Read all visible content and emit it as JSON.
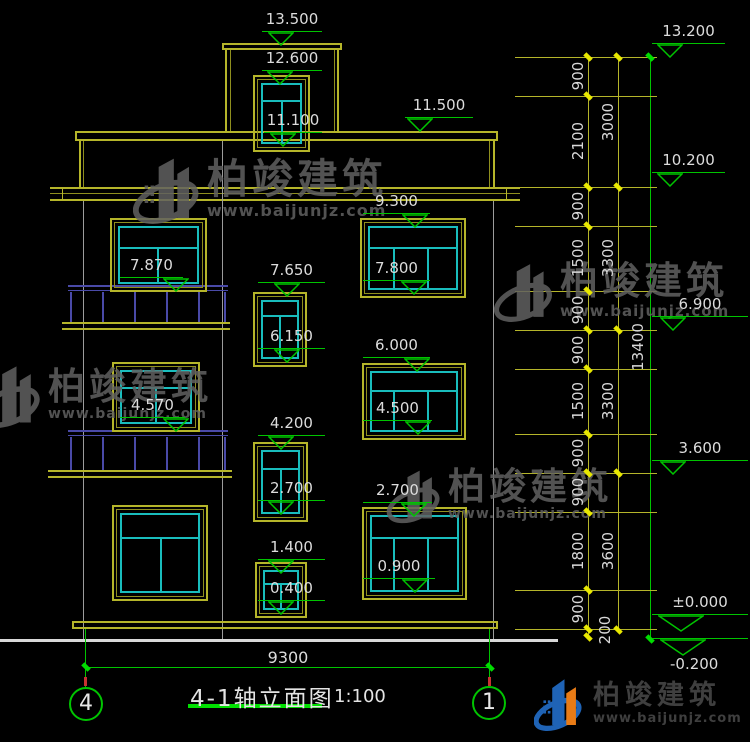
{
  "drawing": {
    "title": "4-1轴立面图",
    "scale": "1:100",
    "bottom_dim": "9300",
    "axis_left": "4",
    "axis_right": "1"
  },
  "elevations": [
    "13.500",
    "12.600",
    "11.100",
    "11.500",
    "9.300",
    "7.870",
    "7.650",
    "7.800",
    "6.150",
    "6.000",
    "4.570",
    "4.200",
    "4.500",
    "2.700",
    "2.700",
    "1.400",
    "0.900",
    "0.400",
    "13.200",
    "10.200",
    "6.900",
    "3.600",
    "±0.000",
    "-0.200"
  ],
  "dims": {
    "inner": [
      "900",
      "2100",
      "900",
      "1500",
      "900",
      "900",
      "1500",
      "900",
      "900",
      "1800",
      "900",
      "200"
    ],
    "middle": [
      "3000",
      "3300",
      "3300",
      "3600"
    ],
    "overall": "13400"
  },
  "watermark": {
    "brand": "柏竣建筑",
    "url": "www.baijunjz.com"
  },
  "logo": {
    "brand": "柏竣建筑",
    "url": "www.baijunjz.com"
  },
  "colors": {
    "wall_yellow": "#b5b52a",
    "glass_cyan": "#19bdbd",
    "marker_green": "#00c400",
    "railing_navy": "#4a4aa8",
    "text_white": "#dcdcdc",
    "watermark_gray": "#616161",
    "logo_blue": "#1f63b5",
    "logo_orange": "#e87b16"
  }
}
